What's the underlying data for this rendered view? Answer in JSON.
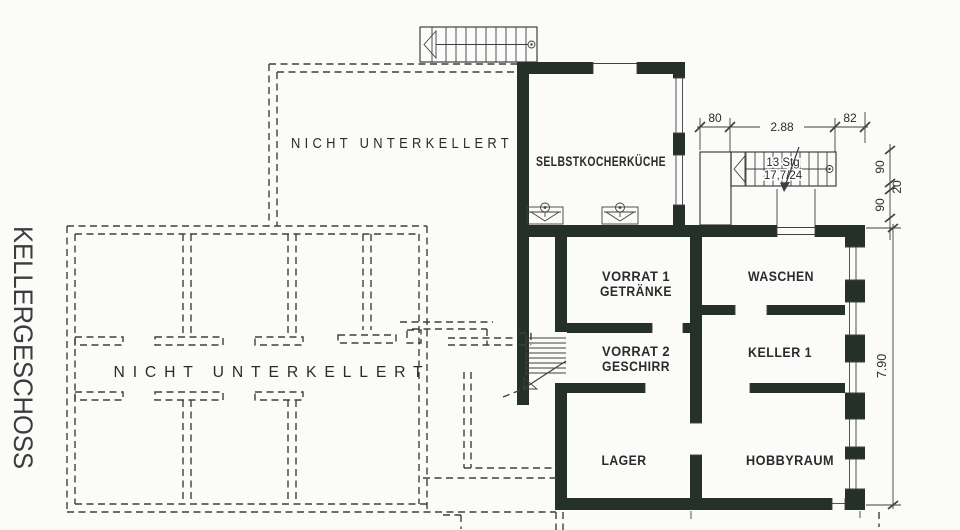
{
  "colors": {
    "background": "#fbfbf9",
    "wall": "#25302a",
    "line": "#3f3f3f",
    "text": "#2b2b2b"
  },
  "title": {
    "floor_name": "KELLERGESCHOSS"
  },
  "regions": {
    "upper_not_cellared": "NICHT UNTERKELLERT",
    "lower_not_cellared": "NICHT UNTERKELLERT"
  },
  "rooms": {
    "kitchen": "SELBSTKOCHERKÜCHE",
    "vorrat1_line1": "VORRAT 1",
    "vorrat1_line2": "GETRÄNKE",
    "waschen": "WASCHEN",
    "vorrat2_line1": "VORRAT 2",
    "vorrat2_line2": "GESCHIRR",
    "keller1": "KELLER 1",
    "lager": "LAGER",
    "hobbyraum": "HOBBYRAUM"
  },
  "stair_annotation": {
    "line1": "13 Stg",
    "line2": "17,7/24"
  },
  "dimensions": {
    "landing_width": "80",
    "stair_run": "2.88",
    "stair_offset": "82",
    "v_top": "90",
    "v_mid": "20",
    "v_bottom": "90",
    "building_depth": "7.90"
  },
  "icons": {
    "sink": "sink-icon",
    "stair_direction": "stair-direction-arrow-icon",
    "stair_start": "stair-start-circle-icon"
  }
}
